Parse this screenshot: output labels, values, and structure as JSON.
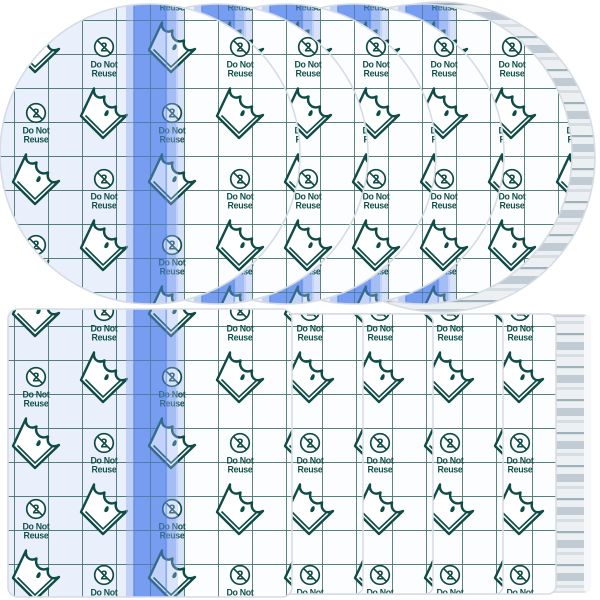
{
  "scene": {
    "kind": "product-photo",
    "subject": "transparent adhesive film dressings",
    "top_row": {
      "shape": "round",
      "visible_sheets": 5,
      "has_stack_edge": true
    },
    "bottom_row": {
      "shape": "rectangular",
      "visible_sheets": 5,
      "has_stack_edge": true
    }
  },
  "markings": {
    "do_not_line": "Do Not",
    "reuse_line": "Reuse",
    "reuse_symbol_numeral": "2"
  },
  "icons": {
    "do_not_reuse": "do-not-reuse-symbol",
    "peel_corner": "peel-corner-dressing-icon"
  },
  "colors": {
    "grid_line": "#2a6157",
    "icon_ink": "#0e4c45",
    "label_ink": "#11514a",
    "stripe_blue": "#7ca2f0",
    "stripe_edge": "#c3d2f7",
    "stripe_overlay": "#6d97f0",
    "sheet_tint": "#e9effb",
    "sheet_white": "#fcfdff",
    "edge_stroke": "#d6dce4",
    "stack_base": "#ecf0f3",
    "stack_stripe_thin": "#9fb2bb",
    "stack_stripe_thick": "#c0cbd3"
  }
}
